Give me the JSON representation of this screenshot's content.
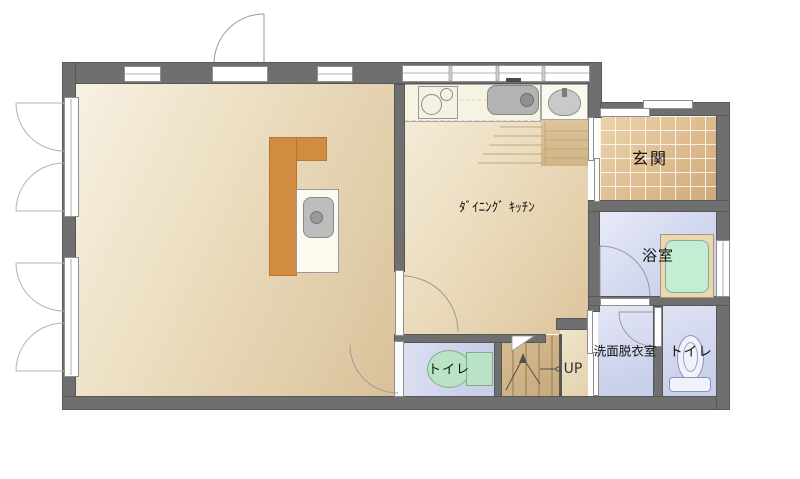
{
  "rooms": {
    "dining_kitchen": {
      "label": "ﾀﾞｲﾆﾝｸﾞ ｷｯﾁﾝ"
    },
    "entrance": {
      "label": "玄関"
    },
    "bathroom": {
      "label": "浴室"
    },
    "washroom": {
      "label": "洗面脱衣室"
    },
    "toilet_main": {
      "label": "トイレ"
    },
    "toilet_hall": {
      "label": "トイレ"
    },
    "stairs": {
      "direction_label": "UP"
    }
  },
  "colors": {
    "wall": "#6f6f6f",
    "room_floor": "#e6d6b8",
    "entrance_tile": "#debf96",
    "wet_room_floor": "#ccd3ec",
    "bathtub": "#c4eed4",
    "toilet_fixture_green": "#b9e3c4",
    "counter_orange": "#d28c42",
    "stairs_wood": "#cdb086"
  }
}
